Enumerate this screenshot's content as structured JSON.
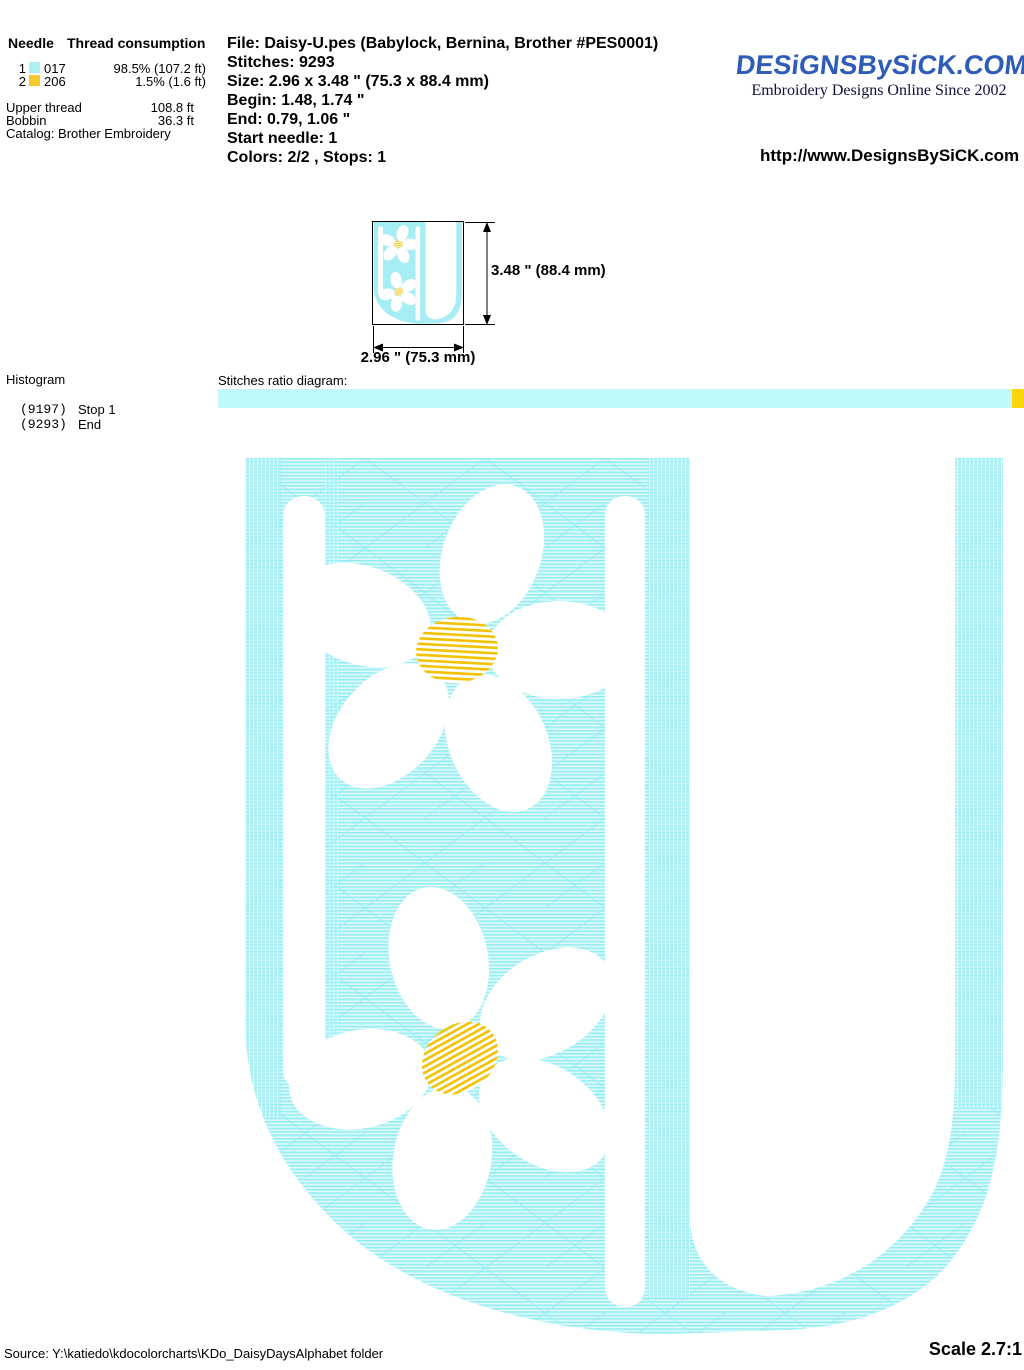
{
  "thread_info": {
    "header_needle": "Needle",
    "header_consumption": "Thread consumption",
    "needles": [
      {
        "num": "1",
        "swatch": "#aeeff1",
        "code": "017",
        "consumption": "98.5% (107.2 ft)"
      },
      {
        "num": "2",
        "swatch": "#f6c92e",
        "code": "206",
        "consumption": "1.5% (1.6 ft)"
      }
    ],
    "upper_thread_label": "Upper thread",
    "upper_thread_value": "108.8 ft",
    "bobbin_label": "Bobbin",
    "bobbin_value": "36.3 ft",
    "catalog": "Catalog: Brother Embroidery"
  },
  "file_info": {
    "file": "File: Daisy-U.pes  (Babylock, Bernina, Brother #PES0001)",
    "stitches": "Stitches: 9293",
    "size": "Size: 2.96 x 3.48 \" (75.3 x 88.4 mm)",
    "begin": "Begin: 1.48, 1.74 \"",
    "end": "End: 0.79, 1.06 \"",
    "start_needle": "Start needle: 1",
    "colors": "Colors: 2/2 , Stops: 1"
  },
  "branding": {
    "logo": "DESiGNSBySiCK.COM",
    "tagline": "Embroidery Designs Online Since 2002",
    "url": "http://www.DesignsBySiCK.com",
    "logo_color": "#2e5cb8"
  },
  "preview": {
    "height_label": "3.48 \" (88.4 mm)",
    "width_label": "2.96 \" (75.3 mm)"
  },
  "histogram": {
    "title": "Histogram",
    "entries": [
      {
        "count": "(9197)",
        "label": "Stop 1"
      },
      {
        "count": "(9293)",
        "label": "End"
      }
    ]
  },
  "ratio": {
    "label": "Stitches ratio diagram:",
    "main_color": "#c0f9fa",
    "tail_color": "#ffd60a"
  },
  "design": {
    "letter": "U",
    "stitch_cyan": "#b5f2f6",
    "accent_yellow": "#f2c200",
    "petal_white": "#ffffff"
  },
  "footer": {
    "source": "Source: Y:\\katiedo\\kdocolorcharts\\KDo_DaisyDaysAlphabet folder",
    "scale": "Scale 2.7:1"
  }
}
